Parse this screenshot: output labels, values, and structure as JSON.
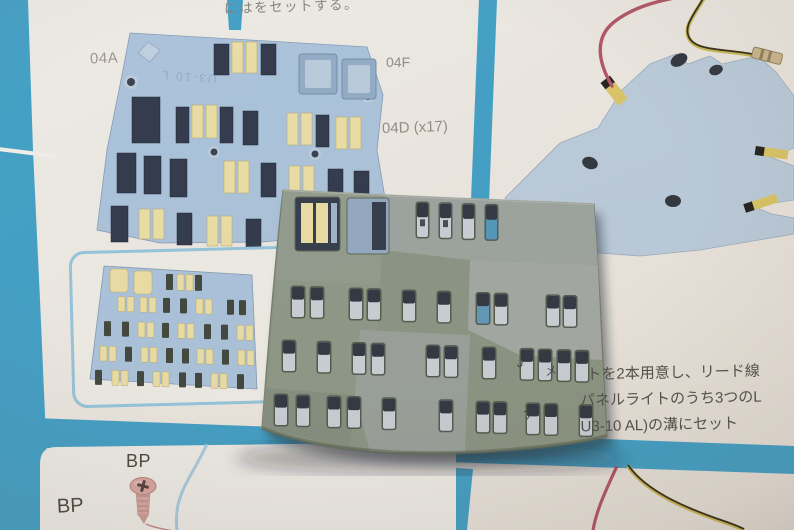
{
  "instruction_sheet": {
    "top_caption": "にはをセットする。",
    "main_panel_diagram": {
      "part_label_left": "04A",
      "part_label_top_right": "04F",
      "part_label_mid_right": "04D (x17)",
      "molded_part_number": "U3-10 L"
    },
    "step_text": {
      "line1": "トを2本用意し、リード線",
      "line2": "パネルライトのうち3つのL",
      "line3": "U3-10 AL)の溝にセット"
    },
    "bottom_left_panel": {
      "screw_label": "BP",
      "screw_label_2": "BP"
    }
  },
  "physical_part": {
    "surface_marks": [
      "J",
      "メ",
      "ア"
    ]
  },
  "colors": {
    "paper": "#e9e5de",
    "divider_blue": "#3a9dc5",
    "panel_blue": "#a6c0da",
    "panel_blue_light": "#b8c9da",
    "slot_navy": "#2a3347",
    "light_yellow": "#e8dc9f",
    "part_gray": "#87917f",
    "wire_red": "#b04f60",
    "wire_yellow": "#c7b44c",
    "screw_pink": "#d7a29e",
    "inset_border": "#8fc2da"
  }
}
